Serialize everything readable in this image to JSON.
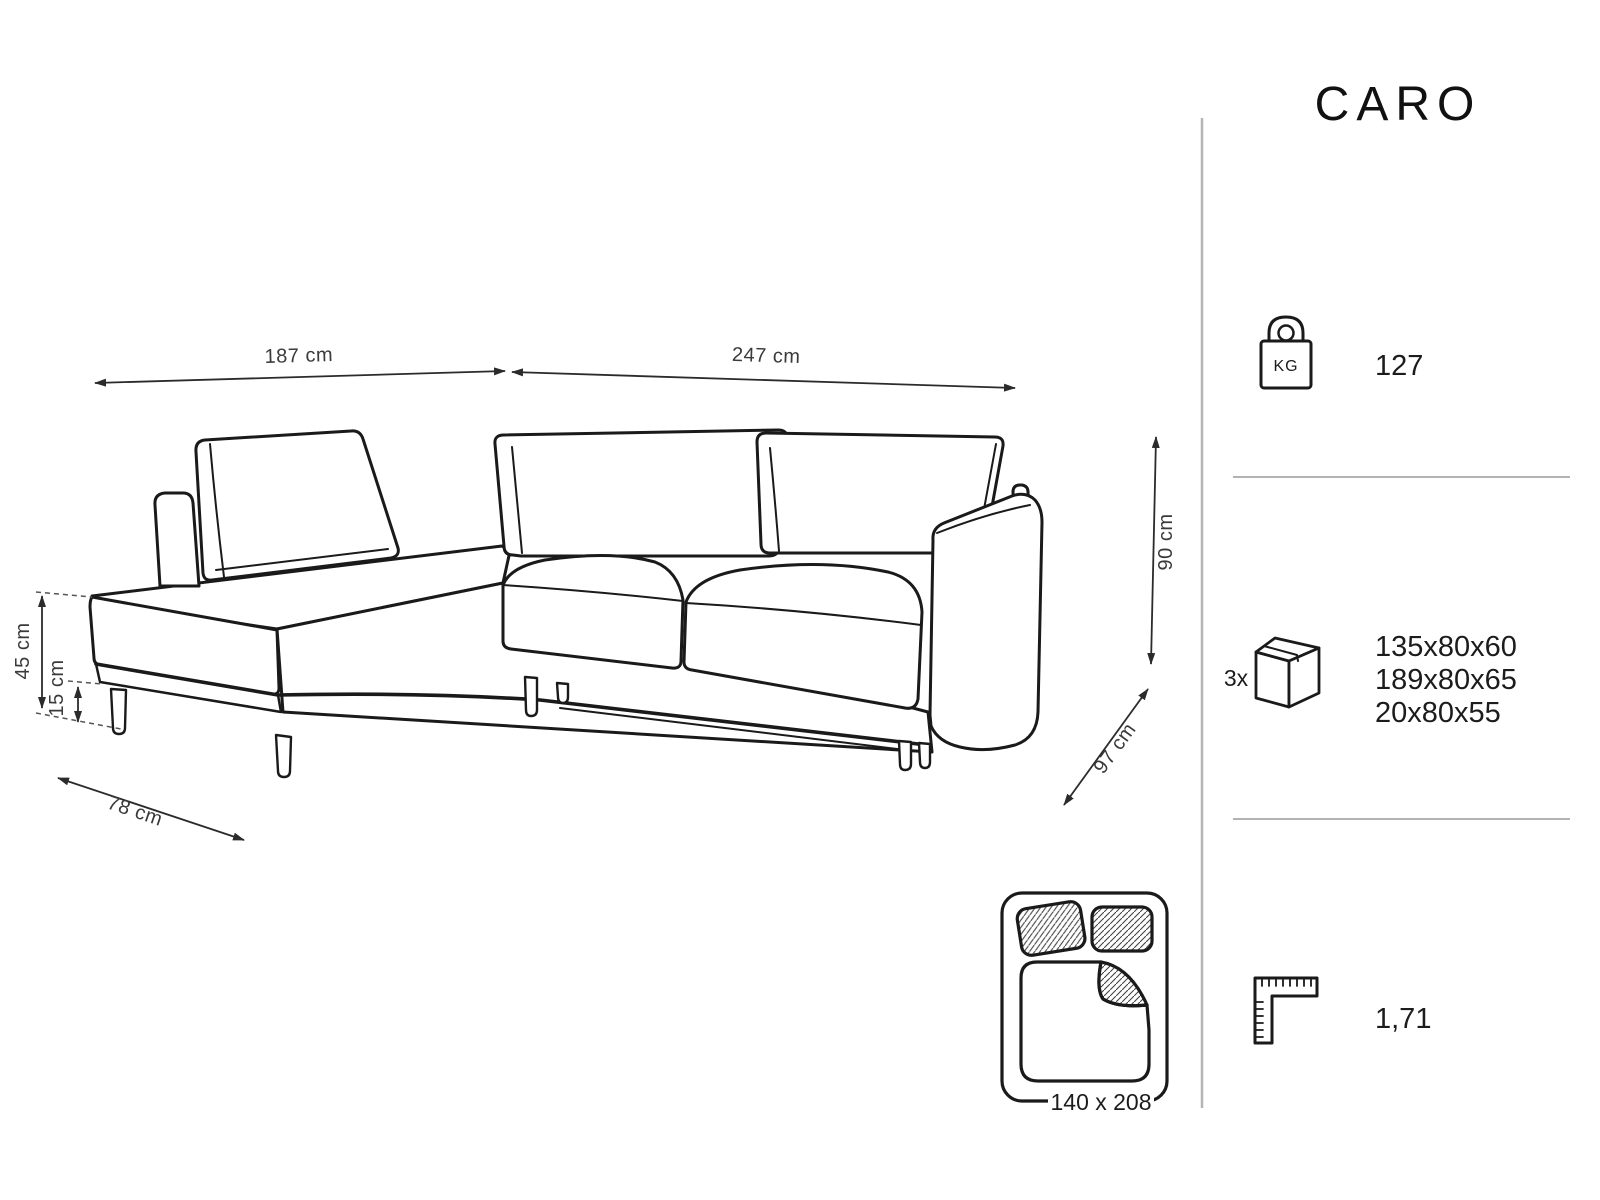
{
  "title": "CARO",
  "diagram": {
    "dim_back_left": "187 cm",
    "dim_back_right": "247 cm",
    "dim_height": "90 cm",
    "dim_depth": "97 cm",
    "dim_chaise_depth": "78 cm",
    "dim_seat_height": "45 cm",
    "dim_leg_height": "15 cm",
    "bed_size": "140 x 208"
  },
  "specs": {
    "weight_kg": "127",
    "weight_unit_label": "KG",
    "boxes_count": "3x",
    "box_dims": [
      "135x80x60",
      "189x80x65",
      "20x80x55"
    ],
    "volume_m3": "1,71"
  },
  "colors": {
    "line": "#1a1a1a",
    "dim": "#3a3a3a",
    "divider": "#b5b5b5",
    "separator": "#999999",
    "background": "#ffffff"
  }
}
